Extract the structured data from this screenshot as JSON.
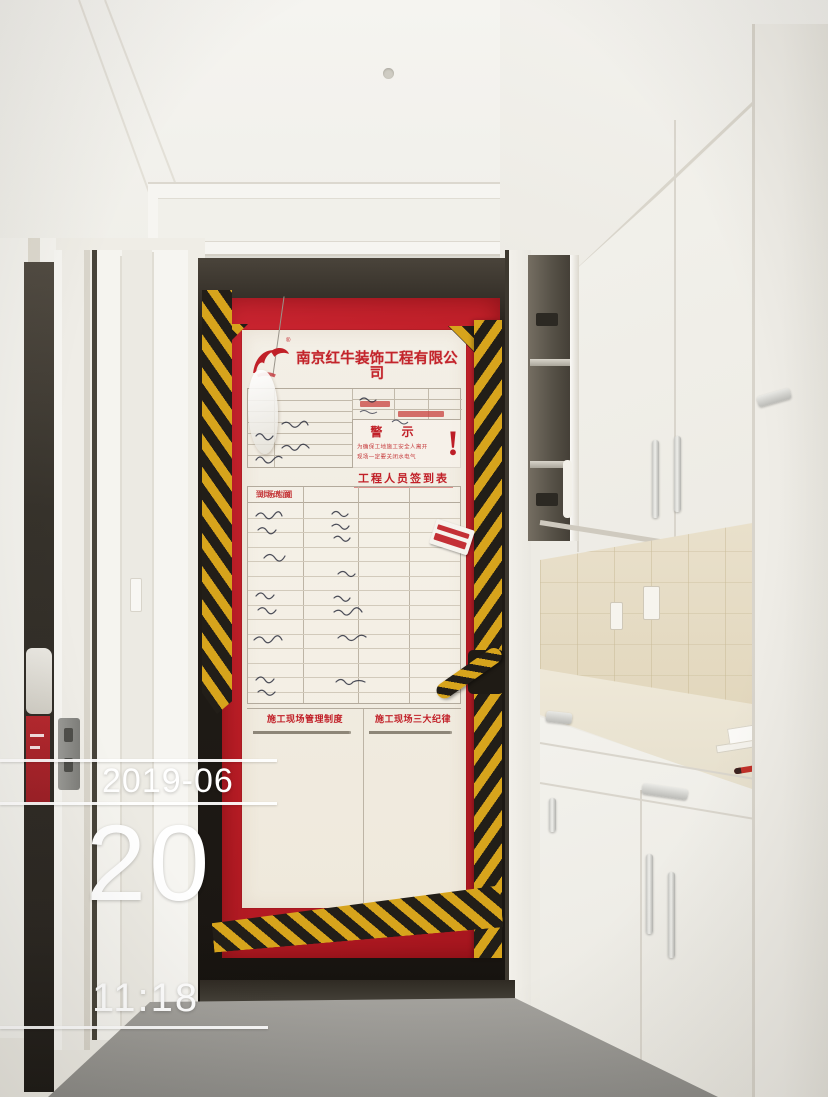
{
  "door_sign": {
    "company_name": "南京红牛装饰工程有限公司",
    "registered_mark": "®",
    "warning": {
      "title": "警 示",
      "line1": "为确保工地施工安全人离开",
      "line2": "现场一定要关闭水电气",
      "mark": "!"
    },
    "signin": {
      "title": "工程人员签到表",
      "columns": [
        "到场人员",
        "到场时间",
        "到场人员",
        "到场时间"
      ]
    },
    "rules_left_title": "施工现场管理制度",
    "rules_right_title": "施工现场三大纪律"
  },
  "timestamp": {
    "date": "2019-06",
    "day": "20",
    "time": "11:18"
  },
  "colors": {
    "sheet_red": "#bf1f28",
    "hazard_yellow": "#d7a41c",
    "hazard_black": "#221e18",
    "overlay_white": "#ffffff"
  }
}
